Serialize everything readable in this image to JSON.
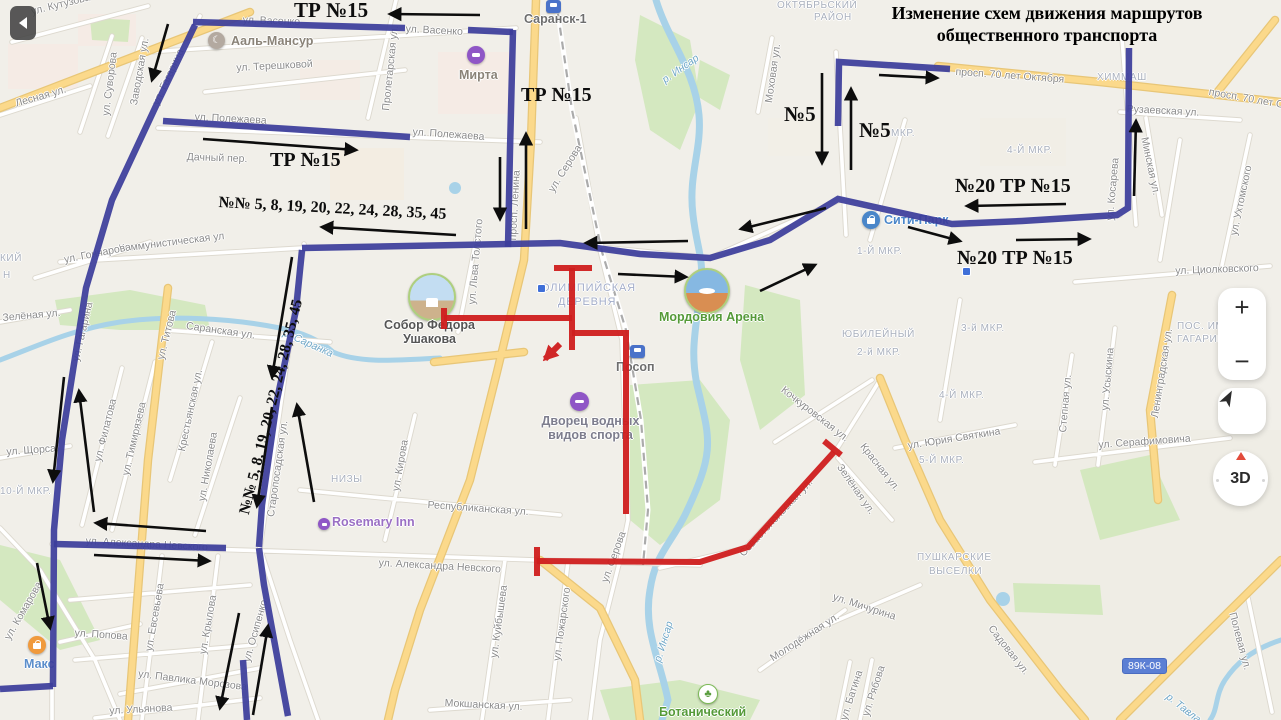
{
  "title": {
    "line1": "Изменение схем движения маршрутов",
    "line2": "общественного транспорта"
  },
  "colors": {
    "route_blue": "#3c3d9b",
    "route_red": "#cf1d1d",
    "arrow_black": "#0d0d0d"
  },
  "controls": {
    "zoom_in": "+",
    "zoom_out": "−",
    "view_3d": "3D"
  },
  "road_badge": {
    "text": "89К-08",
    "x": 1122,
    "y": 658
  },
  "route_annotations": [
    {
      "t": "ТР №15",
      "x": 294,
      "y": -2,
      "s": 21,
      "r": 0
    },
    {
      "t": "ТР №15",
      "x": 521,
      "y": 84,
      "s": 20,
      "r": 0
    },
    {
      "t": "ТР №15",
      "x": 270,
      "y": 149,
      "s": 20,
      "r": 0
    },
    {
      "t": "№№ 5, 8, 19, 20, 22, 24, 28, 35, 45",
      "x": 219,
      "y": 194,
      "s": 16,
      "r": 3
    },
    {
      "t": "№№ 5, 8, 19, 20, 22, 24, 28, 35, 45",
      "x": 236,
      "y": 512,
      "s": 15.5,
      "r": -76
    },
    {
      "t": "№5",
      "x": 784,
      "y": 102,
      "s": 21,
      "r": 0
    },
    {
      "t": "№5",
      "x": 859,
      "y": 118,
      "s": 21,
      "r": 0
    },
    {
      "t": "№20 ТР №15",
      "x": 955,
      "y": 175,
      "s": 20,
      "r": 0
    },
    {
      "t": "№20 ТР №15",
      "x": 957,
      "y": 247,
      "s": 20,
      "r": 0
    }
  ],
  "map_labels": [
    {
      "t": "ул. Кутузова",
      "x": 30,
      "y": 6,
      "r": -14,
      "c": "s"
    },
    {
      "t": "ул. Васенко",
      "x": 243,
      "y": 14,
      "r": 2,
      "c": "s"
    },
    {
      "t": "ул. Васенко",
      "x": 406,
      "y": 23,
      "r": 3,
      "c": "s"
    },
    {
      "t": "ул. Терешковой",
      "x": 236,
      "y": 62,
      "r": -3,
      "c": "s"
    },
    {
      "t": "ул. Суворова",
      "x": 100,
      "y": 115,
      "r": -83,
      "c": "s"
    },
    {
      "t": "Заводская ул.",
      "x": 128,
      "y": 104,
      "r": -80,
      "c": "s"
    },
    {
      "t": "ул. Гагарина",
      "x": 150,
      "y": 102,
      "r": -65,
      "c": "s"
    },
    {
      "t": "Пролетарская ул.",
      "x": 380,
      "y": 110,
      "r": -84,
      "c": "s"
    },
    {
      "t": "Лесная ул.",
      "x": 14,
      "y": 98,
      "r": -16,
      "c": "s"
    },
    {
      "t": "ул. Полежаева",
      "x": 195,
      "y": 111,
      "r": 3,
      "c": "s"
    },
    {
      "t": "ул. Полежаева",
      "x": 413,
      "y": 126,
      "r": 4,
      "c": "s"
    },
    {
      "t": "Дачный пер.",
      "x": 187,
      "y": 151,
      "r": 2,
      "c": "s"
    },
    {
      "t": "просп. Ленина",
      "x": 507,
      "y": 240,
      "r": -87,
      "c": "s"
    },
    {
      "t": "ул. Серова",
      "x": 546,
      "y": 188,
      "r": -58,
      "c": "s"
    },
    {
      "t": "Коммунистическая ул",
      "x": 118,
      "y": 243,
      "r": -7,
      "c": "s"
    },
    {
      "t": "ул. Гончарова",
      "x": 63,
      "y": 254,
      "r": -11,
      "c": "s"
    },
    {
      "t": "КИЙ",
      "x": 0,
      "y": 253,
      "r": 0,
      "c": "d"
    },
    {
      "t": "Н",
      "x": 3,
      "y": 270,
      "r": 0,
      "c": "d"
    },
    {
      "t": "Зелёная ул.",
      "x": 2,
      "y": 312,
      "r": -5,
      "c": "s"
    },
    {
      "t": "ул. Титова",
      "x": 155,
      "y": 358,
      "r": -76,
      "c": "s"
    },
    {
      "t": "ул. Гагарина",
      "x": 70,
      "y": 360,
      "r": -77,
      "c": "s"
    },
    {
      "t": "Саранская ул.",
      "x": 187,
      "y": 320,
      "r": 8,
      "c": "s"
    },
    {
      "t": "р. Саранка",
      "x": 286,
      "y": 327,
      "r": 24,
      "c": "w"
    },
    {
      "t": "ул. Филатова",
      "x": 92,
      "y": 460,
      "r": -76,
      "c": "s"
    },
    {
      "t": "ул. Тимирязева",
      "x": 120,
      "y": 474,
      "r": -77,
      "c": "s"
    },
    {
      "t": "Крестьянская ул.",
      "x": 176,
      "y": 450,
      "r": -78,
      "c": "s"
    },
    {
      "t": "ул. Николаева",
      "x": 196,
      "y": 500,
      "r": -80,
      "c": "s"
    },
    {
      "t": "Старопосадская ул.",
      "x": 265,
      "y": 516,
      "r": -82,
      "c": "s"
    },
    {
      "t": "ул. Щорса",
      "x": 6,
      "y": 446,
      "r": -4,
      "c": "s"
    },
    {
      "t": "10-Й МКР.",
      "x": 0,
      "y": 486,
      "r": 0,
      "c": "d"
    },
    {
      "t": "НИЗЫ",
      "x": 331,
      "y": 474,
      "r": 0,
      "c": "d"
    },
    {
      "t": "ул. Кирова",
      "x": 390,
      "y": 490,
      "r": -80,
      "c": "s"
    },
    {
      "t": "Республиканская ул.",
      "x": 428,
      "y": 499,
      "r": 4,
      "c": "s"
    },
    {
      "t": "ул. Александра Невского",
      "x": 86,
      "y": 535,
      "r": 3,
      "c": "s"
    },
    {
      "t": "ул. Александра Невского",
      "x": 379,
      "y": 557,
      "r": 3,
      "c": "s"
    },
    {
      "t": "ул. Комарова",
      "x": 2,
      "y": 636,
      "r": -60,
      "c": "s"
    },
    {
      "t": "ул. Попова",
      "x": 75,
      "y": 627,
      "r": 4,
      "c": "s"
    },
    {
      "t": "ул. Евсевьева",
      "x": 143,
      "y": 650,
      "r": -80,
      "c": "s"
    },
    {
      "t": "ул. Крылова",
      "x": 197,
      "y": 653,
      "r": -80,
      "c": "s"
    },
    {
      "t": "ул. Павлика Морозова",
      "x": 139,
      "y": 668,
      "r": 7,
      "c": "s"
    },
    {
      "t": "ул. Ульянова",
      "x": 109,
      "y": 705,
      "r": -3,
      "c": "s"
    },
    {
      "t": "ул. Осипенко",
      "x": 241,
      "y": 660,
      "r": -74,
      "c": "s"
    },
    {
      "t": "Мокшанская ул.",
      "x": 445,
      "y": 697,
      "r": 3,
      "c": "s"
    },
    {
      "t": "ул. Куйбышева",
      "x": 488,
      "y": 657,
      "r": -82,
      "c": "s"
    },
    {
      "t": "ул. Пожарского",
      "x": 551,
      "y": 660,
      "r": -82,
      "c": "s"
    },
    {
      "t": "ул. Серова",
      "x": 599,
      "y": 580,
      "r": -70,
      "c": "s"
    },
    {
      "t": "р. Инсар",
      "x": 652,
      "y": 660,
      "r": -73,
      "c": "w"
    },
    {
      "t": "р. Инсар",
      "x": 660,
      "y": 76,
      "r": -35,
      "c": "w"
    },
    {
      "t": "Моховая ул.",
      "x": 763,
      "y": 102,
      "r": -82,
      "c": "s"
    },
    {
      "t": "ОКТЯБРЬСКИЙ",
      "x": 777,
      "y": 0,
      "r": 0,
      "c": "d"
    },
    {
      "t": "РАЙОН",
      "x": 814,
      "y": 12,
      "r": 0,
      "c": "d"
    },
    {
      "t": "просп. 70 лет Октября",
      "x": 956,
      "y": 66,
      "r": 4,
      "c": "s"
    },
    {
      "t": "просп. 70 лет Октября",
      "x": 1210,
      "y": 86,
      "r": 10,
      "c": "s"
    },
    {
      "t": "ХИММАШ",
      "x": 1097,
      "y": 72,
      "r": 0,
      "c": "d"
    },
    {
      "t": "Рузаевская ул.",
      "x": 1127,
      "y": 103,
      "r": 3,
      "c": "s"
    },
    {
      "t": "Минская ул.",
      "x": 1150,
      "y": 136,
      "r": 78,
      "c": "s"
    },
    {
      "t": "ул. Косарева",
      "x": 1104,
      "y": 220,
      "r": -85,
      "c": "s"
    },
    {
      "t": "ул. Ухтомского",
      "x": 1228,
      "y": 234,
      "r": -78,
      "c": "s"
    },
    {
      "t": "МКР.",
      "x": 891,
      "y": 128,
      "r": 0,
      "c": "d"
    },
    {
      "t": "4-Й МКР.",
      "x": 1007,
      "y": 145,
      "r": 0,
      "c": "d"
    },
    {
      "t": "1-Й МКР.",
      "x": 857,
      "y": 246,
      "r": 0,
      "c": "d"
    },
    {
      "t": "ул. Циолковского",
      "x": 1175,
      "y": 265,
      "r": -2,
      "c": "s"
    },
    {
      "t": "ЮБИЛЕЙНЫЙ",
      "x": 842,
      "y": 329,
      "r": 0,
      "c": "d"
    },
    {
      "t": "2-й МКР.",
      "x": 857,
      "y": 347,
      "r": 0,
      "c": "d"
    },
    {
      "t": "3-й МКР.",
      "x": 961,
      "y": 323,
      "r": 0,
      "c": "d"
    },
    {
      "t": "4-Й МКР.",
      "x": 939,
      "y": 390,
      "r": 0,
      "c": "d"
    },
    {
      "t": "5-Й МКР.",
      "x": 919,
      "y": 455,
      "r": 0,
      "c": "d"
    },
    {
      "t": "ул. Юрия Святкина",
      "x": 907,
      "y": 440,
      "r": -9,
      "c": "s"
    },
    {
      "t": "Кочкуровская ул.",
      "x": 786,
      "y": 384,
      "r": 38,
      "c": "s"
    },
    {
      "t": "Красная ул.",
      "x": 867,
      "y": 441,
      "r": 52,
      "c": "s"
    },
    {
      "t": "Зелёная ул.",
      "x": 844,
      "y": 462,
      "r": 55,
      "c": "s"
    },
    {
      "t": "Севастопольская ул.",
      "x": 737,
      "y": 551,
      "r": -47,
      "c": "s"
    },
    {
      "t": "ПУШКАРСКИЕ",
      "x": 917,
      "y": 552,
      "r": 0,
      "c": "d"
    },
    {
      "t": "ВЫСЕЛКИ",
      "x": 929,
      "y": 566,
      "r": 0,
      "c": "d"
    },
    {
      "t": "ул. Серафимовича",
      "x": 1098,
      "y": 439,
      "r": -4,
      "c": "s"
    },
    {
      "t": "Степная ул.",
      "x": 1057,
      "y": 432,
      "r": -85,
      "c": "s"
    },
    {
      "t": "ул. Усыскина",
      "x": 1099,
      "y": 410,
      "r": -85,
      "c": "s"
    },
    {
      "t": "Ленинградская ул.",
      "x": 1149,
      "y": 417,
      "r": -81,
      "c": "s"
    },
    {
      "t": "ПОС. ИМ.",
      "x": 1177,
      "y": 321,
      "r": 0,
      "c": "d"
    },
    {
      "t": "ГАГАРИНА",
      "x": 1177,
      "y": 334,
      "r": 0,
      "c": "d"
    },
    {
      "t": "ул. Мичурина",
      "x": 835,
      "y": 591,
      "r": 18,
      "c": "s"
    },
    {
      "t": "Молодёжная ул.",
      "x": 768,
      "y": 654,
      "r": -33,
      "c": "s"
    },
    {
      "t": "ул. Рябова",
      "x": 860,
      "y": 714,
      "r": -72,
      "c": "s"
    },
    {
      "t": "ул. Батина",
      "x": 838,
      "y": 718,
      "r": -72,
      "c": "s"
    },
    {
      "t": "Садовая ул.",
      "x": 995,
      "y": 623,
      "r": 52,
      "c": "s"
    },
    {
      "t": "р. Тавла",
      "x": 1171,
      "y": 691,
      "r": 38,
      "c": "w"
    },
    {
      "t": "Полевая ул.",
      "x": 1238,
      "y": 611,
      "r": 75,
      "c": "s"
    },
    {
      "t": "ул. Льва Толстого",
      "x": 466,
      "y": 304,
      "r": -85,
      "c": "s"
    },
    {
      "t": "ОЛИМПИЙСКАЯ",
      "x": 541,
      "y": 282,
      "r": 0,
      "c": "a"
    },
    {
      "t": "ДЕРЕВНЯ",
      "x": 558,
      "y": 296,
      "r": 0,
      "c": "a"
    }
  ],
  "pois": [
    {
      "type": "station",
      "x": 546,
      "y": 0,
      "lines": [
        "Саранск-1"
      ],
      "lx": 524,
      "ly": 12,
      "lc": "#6e6e6e"
    },
    {
      "type": "mosque",
      "x": 208,
      "y": 32,
      "lines": [
        "Ааль-Мансур"
      ],
      "lx": 231,
      "ly": 34,
      "lc": "#8a8378"
    },
    {
      "type": "hotel",
      "x": 467,
      "y": 46,
      "lines": [
        "Мирта"
      ],
      "lx": 459,
      "ly": 68,
      "lc": "#8a8378"
    },
    {
      "type": "mall",
      "x": 862,
      "y": 211,
      "lines": [
        "Сити-Парк"
      ],
      "lx": 884,
      "ly": 213,
      "lc": "#4a86c9"
    },
    {
      "type": "photo-cathedral",
      "x": 408,
      "y": 273,
      "lines": [
        "Собор Федора",
        "Ушакова"
      ],
      "lx": 382,
      "ly": 318,
      "lc": "#555555",
      "lw": 95
    },
    {
      "type": "photo-stadium",
      "x": 684,
      "y": 268,
      "lines": [
        "Мордовия Арена"
      ],
      "lx": 659,
      "ly": 310,
      "lc": "#559a38"
    },
    {
      "type": "station",
      "x": 630,
      "y": 345,
      "lines": [
        "Посоп"
      ],
      "lx": 616,
      "ly": 360,
      "lc": "#6e6e6e"
    },
    {
      "type": "pool",
      "x": 570,
      "y": 392,
      "lines": [
        "Дворец водных",
        "видов спорта"
      ],
      "lx": 528,
      "ly": 414,
      "lc": "#7d7d8d",
      "lw": 125
    },
    {
      "type": "hotel-sm",
      "x": 318,
      "y": 518,
      "lines": [
        "Rosemary Inn"
      ],
      "lx": 332,
      "ly": 515,
      "lc": "#9a6fc4"
    },
    {
      "type": "mall-o",
      "x": 28,
      "y": 636,
      "lines": [
        "Макс"
      ],
      "lx": 24,
      "ly": 657,
      "lc": "#5b8ecb"
    },
    {
      "type": "park",
      "x": 698,
      "y": 684,
      "lines": [
        "Ботанический"
      ],
      "lx": 659,
      "ly": 705,
      "lc": "#559a38"
    }
  ],
  "stop_dots": [
    {
      "x": 537,
      "y": 284
    },
    {
      "x": 962,
      "y": 267
    }
  ]
}
